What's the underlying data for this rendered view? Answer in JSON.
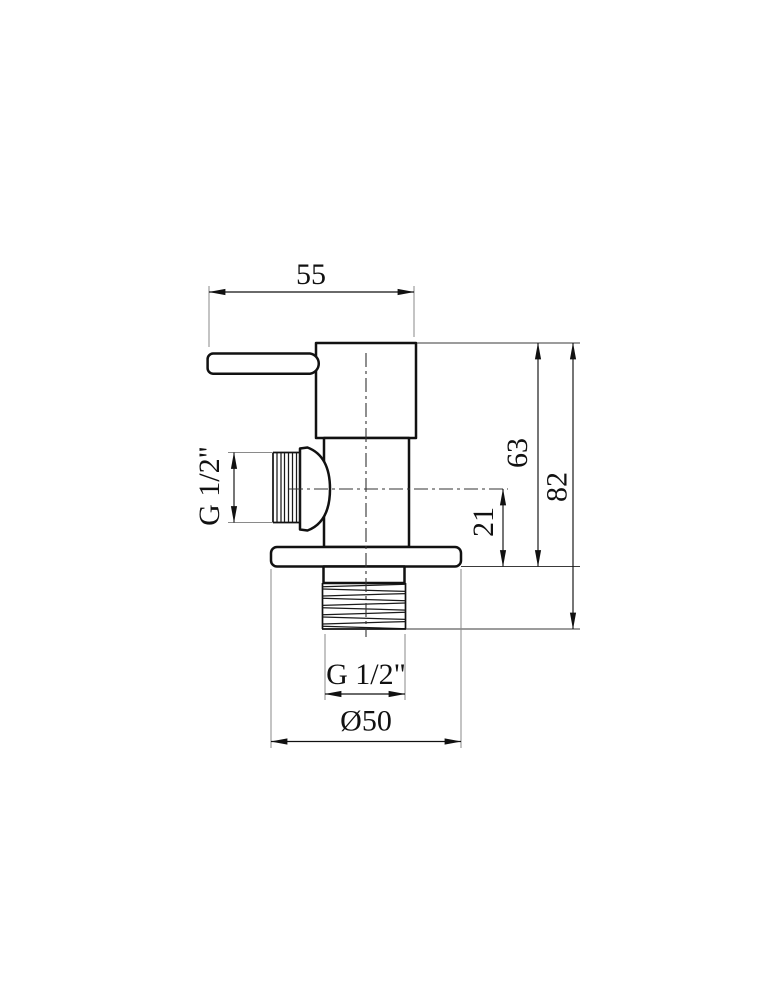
{
  "colors": {
    "line": "#111111",
    "extension_line": "#8a8a8a",
    "background": "#ffffff"
  },
  "dimensions": {
    "top_width": "55",
    "side_thread": "G 1/2\"",
    "upper_height": "63",
    "total_height": "82",
    "outlet_offset": "21",
    "bottom_thread": "G 1/2\"",
    "flange_diameter": "Ø50"
  }
}
